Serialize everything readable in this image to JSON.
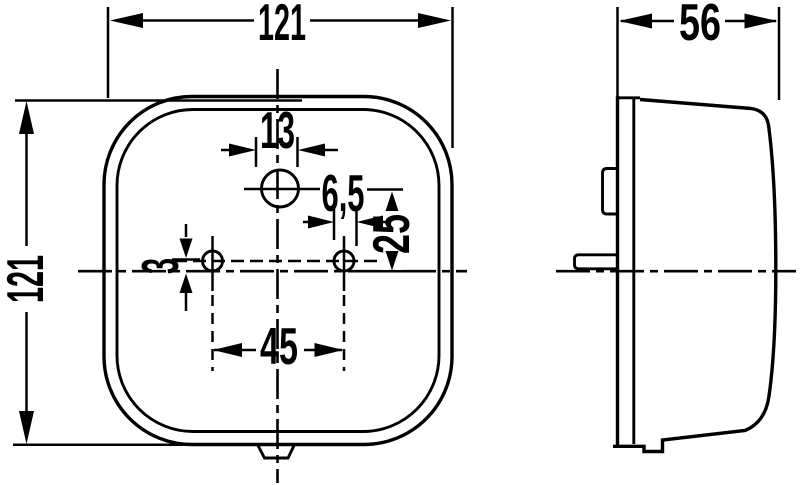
{
  "drawing": {
    "kind": "technical-drawing-lamp",
    "background_color": "#ffffff",
    "line_color": "#000000",
    "views": {
      "front": {
        "name": "front-view"
      },
      "side": {
        "name": "side-view"
      }
    },
    "dimensions": {
      "front_width": "121",
      "front_height": "121",
      "side_depth": "56",
      "top_hole_diameter": "13",
      "small_hole_diameter": "6,5",
      "top_hole_offset": "25",
      "hole_line_offset": "3",
      "hole_spacing": "45"
    }
  }
}
